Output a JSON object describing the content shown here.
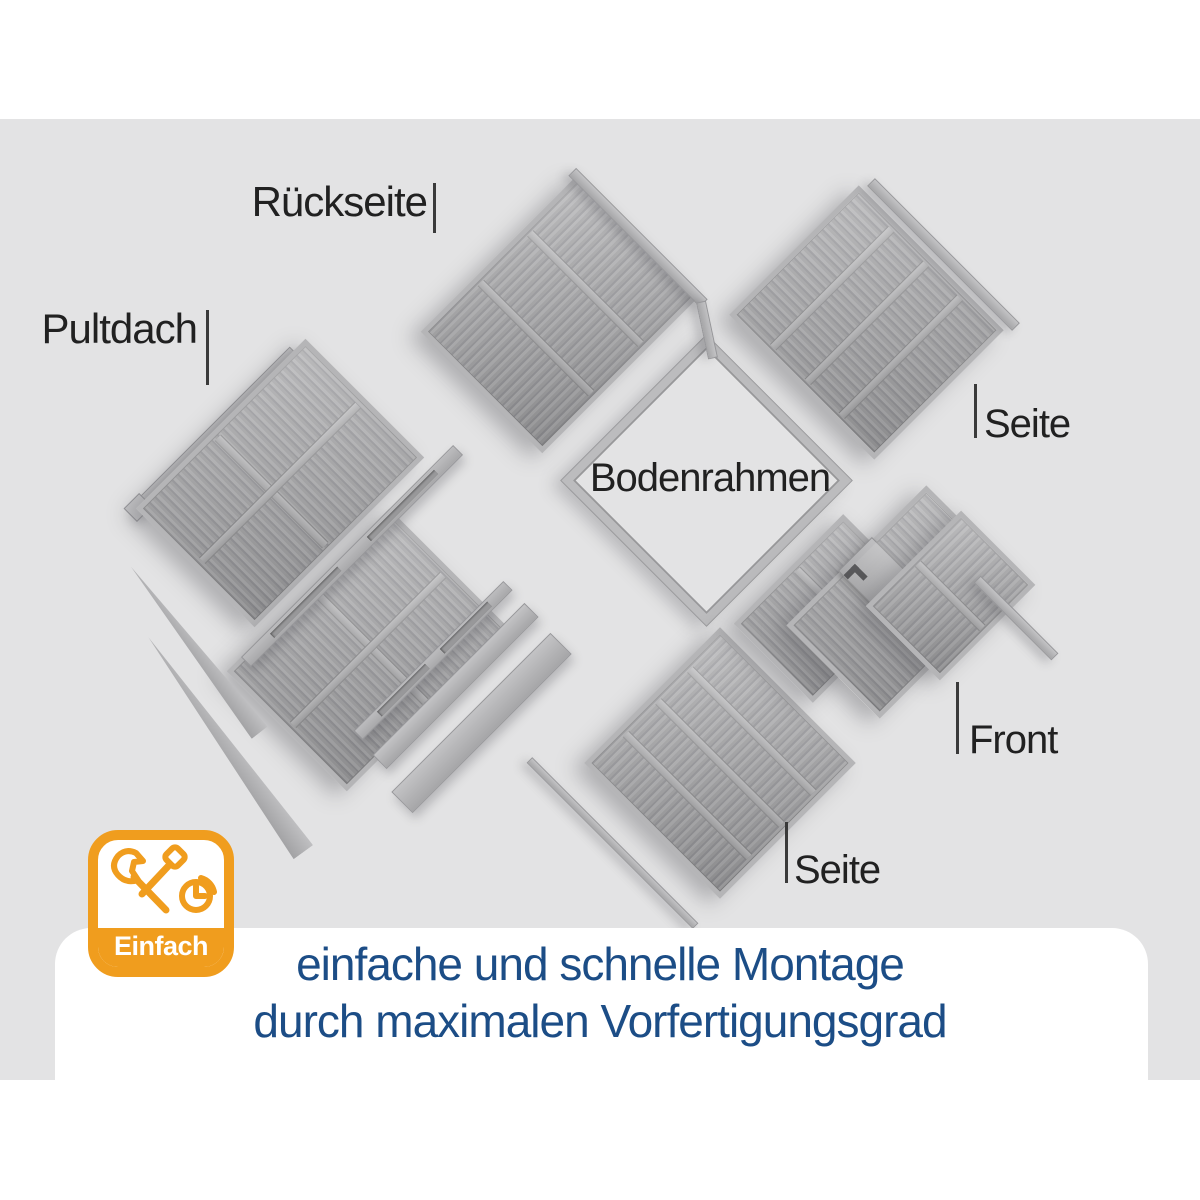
{
  "stage": {
    "bg": "#e3e3e4"
  },
  "labels": [
    {
      "id": "rueckseite",
      "text": "Rückseite",
      "x": 427,
      "y": 181,
      "align": "right",
      "font_size": 42,
      "tick": {
        "x": 433,
        "y1": 183,
        "y2": 233
      }
    },
    {
      "id": "pultdach",
      "text": "Pultdach",
      "x": 197,
      "y": 308,
      "align": "right",
      "font_size": 42,
      "tick": {
        "x": 206,
        "y1": 310,
        "y2": 385
      }
    },
    {
      "id": "seite-rechts",
      "text": "Seite",
      "x": 984,
      "y": 404,
      "align": "left",
      "font_size": 40,
      "tick": {
        "x": 974,
        "y1": 384,
        "y2": 438
      }
    },
    {
      "id": "bodenrahmen",
      "text": "Bodenrahmen",
      "x": 710,
      "y": 458,
      "align": "center",
      "font_size": 40,
      "tick": null
    },
    {
      "id": "front",
      "text": "Front",
      "x": 969,
      "y": 720,
      "align": "left",
      "font_size": 40,
      "tick": {
        "x": 956,
        "y1": 682,
        "y2": 754
      }
    },
    {
      "id": "seite-unten",
      "text": "Seite",
      "x": 794,
      "y": 850,
      "align": "left",
      "font_size": 40,
      "tick": {
        "x": 785,
        "y1": 822,
        "y2": 883
      }
    }
  ],
  "diagram": {
    "parts": [
      {
        "name": "pultdach-ridge-strip",
        "cx": 213,
        "cy": 432,
        "w": 230,
        "h": 13,
        "rot": -45,
        "kind": "smooth",
        "cap": true
      },
      {
        "name": "pultdach-panel-1",
        "cx": 280,
        "cy": 483,
        "w": 168,
        "h": 240,
        "rot": 45,
        "kind": "ribbed-h",
        "seams": [
          50
        ],
        "rails": [
          55
        ]
      },
      {
        "name": "pultdach-panel-2",
        "cx": 368,
        "cy": 650,
        "w": 170,
        "h": 230,
        "rot": 45,
        "kind": "ribbed-h",
        "seams": [
          50
        ],
        "rails": [
          48
        ]
      },
      {
        "name": "pultdach-wedge-1",
        "cx": 195,
        "cy": 650,
        "w": 210,
        "h": 20,
        "rot": 52,
        "kind": "wedge"
      },
      {
        "name": "pultdach-wedge-2",
        "cx": 225,
        "cy": 745,
        "w": 265,
        "h": 24,
        "rot": 54,
        "kind": "wedge"
      },
      {
        "name": "roof-batten-rail-1",
        "cx": 352,
        "cy": 556,
        "w": 300,
        "h": 14,
        "rot": -45,
        "kind": "slotted",
        "slots": [
          12,
          58
        ]
      },
      {
        "name": "roof-batten-rail-2",
        "cx": 433,
        "cy": 660,
        "w": 212,
        "h": 13,
        "rot": -45,
        "kind": "slotted",
        "slots": [
          14,
          56
        ]
      },
      {
        "name": "roof-plank-1",
        "cx": 455,
        "cy": 686,
        "w": 215,
        "h": 20,
        "rot": -45,
        "kind": "smooth"
      },
      {
        "name": "roof-plank-2",
        "cx": 481,
        "cy": 723,
        "w": 225,
        "h": 30,
        "rot": -45,
        "kind": "smooth"
      },
      {
        "name": "floor-batten",
        "cx": 612,
        "cy": 843,
        "w": 235,
        "h": 8,
        "rot": 45,
        "kind": "smooth"
      },
      {
        "name": "bodenrahmen-frame",
        "cx": 706,
        "cy": 480,
        "w": 205,
        "h": 205,
        "rot": 45,
        "kind": "frame"
      },
      {
        "name": "rueckseite-panel",
        "cx": 560,
        "cy": 314,
        "w": 172,
        "h": 222,
        "rot": 45,
        "kind": "ribbed-v",
        "rails": [
          33,
          66
        ]
      },
      {
        "name": "rueckseite-trim",
        "cx": 638,
        "cy": 237,
        "w": 186,
        "h": 11,
        "rot": 45,
        "kind": "smooth"
      },
      {
        "name": "rueckseite-trim-elbow",
        "cx": 707,
        "cy": 330,
        "w": 58,
        "h": 10,
        "rot": 78,
        "kind": "smooth"
      },
      {
        "name": "seite-rechts-panel",
        "cx": 866,
        "cy": 322,
        "w": 205,
        "h": 183,
        "rot": 45,
        "kind": "ribbed-h",
        "seams": [
          25,
          50,
          75
        ]
      },
      {
        "name": "seite-rechts-trim",
        "cx": 943,
        "cy": 254,
        "w": 205,
        "h": 11,
        "rot": 45,
        "kind": "smooth"
      },
      {
        "name": "seite-unten-panel",
        "cx": 720,
        "cy": 763,
        "w": 192,
        "h": 192,
        "rot": 45,
        "kind": "ribbed-v",
        "rails": [
          25,
          50,
          75
        ]
      },
      {
        "name": "front-left-module",
        "cx": 828,
        "cy": 608,
        "w": 112,
        "h": 155,
        "rot": 45,
        "kind": "ribbed-h",
        "rails": [
          46
        ]
      },
      {
        "name": "front-door-module",
        "cx": 903,
        "cy": 602,
        "w": 132,
        "h": 198,
        "rot": 45,
        "kind": "ribbed-h",
        "door": true
      },
      {
        "name": "front-right-module",
        "cx": 950,
        "cy": 595,
        "w": 105,
        "h": 135,
        "rot": 45,
        "kind": "ribbed-v",
        "rails": [
          50
        ]
      },
      {
        "name": "front-corner-strip",
        "cx": 1016,
        "cy": 618,
        "w": 110,
        "h": 10,
        "rot": 45,
        "kind": "smooth"
      }
    ]
  },
  "badge": {
    "label": "Einfach",
    "color": "#f09d1e",
    "icon": "tools-and-clock-icon"
  },
  "caption": {
    "line1": "einfache und schnelle Montage",
    "line2": "durch maximalen Vorfertigungsgrad",
    "color": "#1c4d86"
  },
  "colors": {
    "stage_gray": "#e3e3e4",
    "panel_gray": "#a8a8aa",
    "panel_light": "#b5b5b7",
    "panel_dark": "#96969a",
    "label_text": "#212121",
    "accent_orange": "#f09d1e",
    "caption_blue": "#1c4d86"
  }
}
